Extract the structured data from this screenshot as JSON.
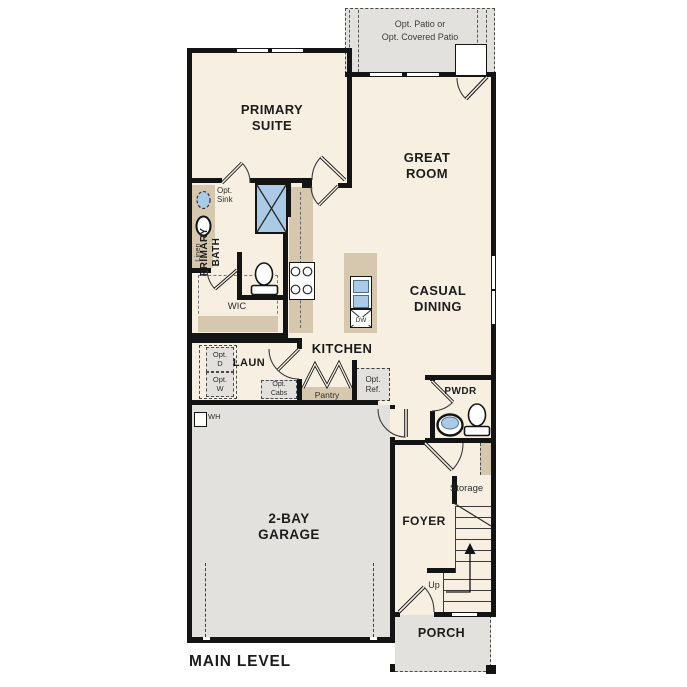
{
  "colors": {
    "wall": "#141414",
    "floor": "#f7efe1",
    "exterior_gray": "#e2e1de",
    "cabinet_tan": "#d5c8ae",
    "fixture_blue": "#abcae5",
    "dashed_outline": "#4a4a4a"
  },
  "labels": {
    "plan_title": "MAIN LEVEL",
    "patio": "Opt. Patio or\nOpt. Covered Patio",
    "primary_suite": "PRIMARY\nSUITE",
    "great_room": "GREAT\nROOM",
    "casual_dining": "CASUAL\nDINING",
    "kitchen": "KITCHEN",
    "primary_bath": "PRIMARY\nBATH",
    "opt_sink": "Opt.\nSink",
    "linen": "Linen",
    "wic": "WIC",
    "laundry": "LAUN",
    "opt_dryer": "Opt.\nD",
    "opt_washer": "Opt.\nW",
    "opt_cabs": "Opt.\nCabs",
    "pantry": "Pantry",
    "opt_ref": "Opt.\nRef.",
    "dishwasher": "DW",
    "water_heater": "WH",
    "pwdr": "PWDR",
    "storage": "Storage",
    "foyer": "FOYER",
    "up": "Up",
    "garage": "2-BAY\nGARAGE",
    "porch": "PORCH"
  }
}
